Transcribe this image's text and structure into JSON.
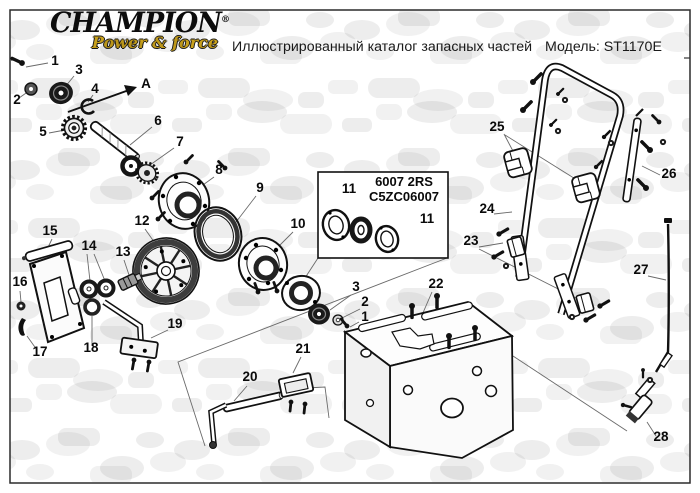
{
  "page": {
    "title": "Иллюстрированный каталог запасных частей",
    "model_label": "Модель: ST1170E"
  },
  "logo": {
    "brand": "CHAMPION",
    "reg": "®",
    "tagline": "Power & force",
    "brand_color": "#0d0d0d",
    "tagline_color": "#c9a11c"
  },
  "callout_box": {
    "line1": "6007 2RS",
    "line2": "C5ZC06007"
  },
  "diagram": {
    "part_labels": [
      {
        "text": "1",
        "x": 55,
        "y": 65
      },
      {
        "text": "2",
        "x": 17,
        "y": 104
      },
      {
        "text": "3",
        "x": 79,
        "y": 74
      },
      {
        "text": "4",
        "x": 95,
        "y": 93
      },
      {
        "text": "5",
        "x": 43,
        "y": 136
      },
      {
        "text": "6",
        "x": 158,
        "y": 125
      },
      {
        "text": "A",
        "x": 146,
        "y": 88
      },
      {
        "text": "7",
        "x": 180,
        "y": 146
      },
      {
        "text": "8",
        "x": 219,
        "y": 174
      },
      {
        "text": "9",
        "x": 260,
        "y": 192
      },
      {
        "text": "10",
        "x": 298,
        "y": 228
      },
      {
        "text": "11",
        "x": 349,
        "y": 193
      },
      {
        "text": "11",
        "x": 427,
        "y": 223
      },
      {
        "text": "12",
        "x": 142,
        "y": 225
      },
      {
        "text": "13",
        "x": 123,
        "y": 256
      },
      {
        "text": "14",
        "x": 89,
        "y": 250
      },
      {
        "text": "15",
        "x": 50,
        "y": 235
      },
      {
        "text": "16",
        "x": 20,
        "y": 286
      },
      {
        "text": "17",
        "x": 40,
        "y": 356
      },
      {
        "text": "18",
        "x": 91,
        "y": 352
      },
      {
        "text": "19",
        "x": 175,
        "y": 328
      },
      {
        "text": "20",
        "x": 250,
        "y": 381
      },
      {
        "text": "21",
        "x": 303,
        "y": 353
      },
      {
        "text": "22",
        "x": 436,
        "y": 288
      },
      {
        "text": "3",
        "x": 356,
        "y": 291
      },
      {
        "text": "2",
        "x": 365,
        "y": 306
      },
      {
        "text": "1",
        "x": 365,
        "y": 321
      },
      {
        "text": "23",
        "x": 471,
        "y": 245
      },
      {
        "text": "24",
        "x": 487,
        "y": 213
      },
      {
        "text": "25",
        "x": 497,
        "y": 131
      },
      {
        "text": "26",
        "x": 669,
        "y": 178
      },
      {
        "text": "27",
        "x": 641,
        "y": 274
      },
      {
        "text": "28",
        "x": 661,
        "y": 441
      }
    ]
  },
  "colors": {
    "border": "#2b2b2b",
    "leader_line": "#6a6a6a",
    "part_outline": "#111111",
    "watermark": "#000000"
  }
}
